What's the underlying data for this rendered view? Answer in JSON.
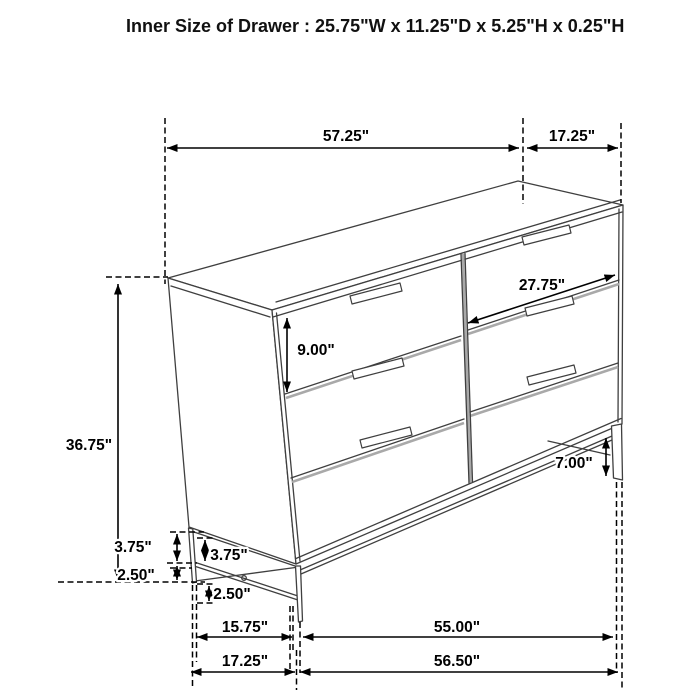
{
  "title": "Inner Size of Drawer : 25.75\"W x 11.25\"D x 5.25\"H x 0.25\"H",
  "diagram": {
    "type": "furniture dimension line drawing",
    "item": "6-drawer dresser on metal base, front-left perspective view",
    "dims": {
      "top_width": "57.25\"",
      "top_depth": "17.25\"",
      "drawer_front_width": "27.75\"",
      "drawer_front_height": "9.00\"",
      "overall_height": "36.75\"",
      "base_upper_side": "3.75\"",
      "base_lower_side": "2.50\"",
      "base_upper_front": "3.75\"",
      "base_lower_front": "2.50\"",
      "leg_height": "7.00\"",
      "base_depth_inner": "15.75\"",
      "base_width_inner": "55.00\"",
      "base_depth_outer": "17.25\"",
      "base_width_outer": "56.50\""
    },
    "colors": {
      "background": "#ffffff",
      "furniture_line": "#3f3f3f",
      "separator_shade": "#a9a9a9",
      "dimension_line": "#000000",
      "label_text": "#000000"
    }
  }
}
